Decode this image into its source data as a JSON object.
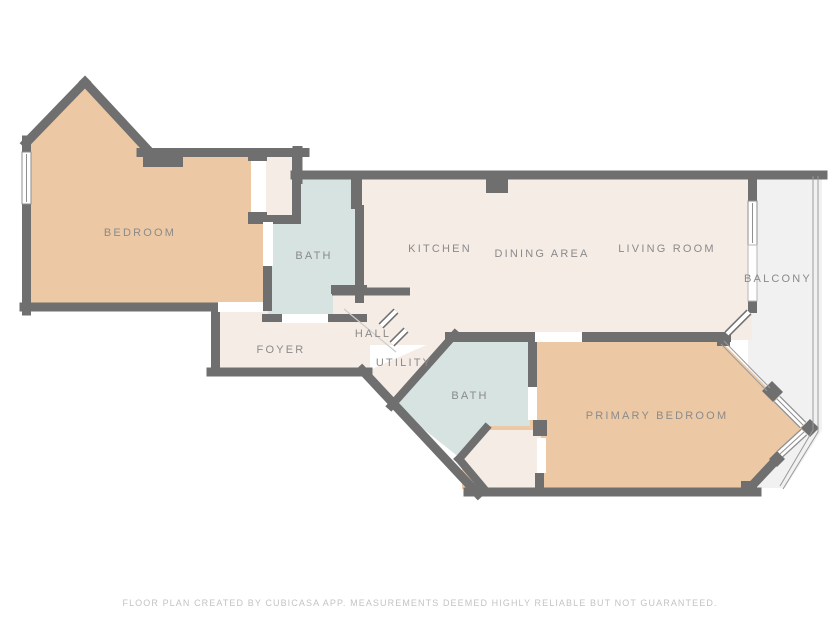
{
  "floor_plan": {
    "rooms": {
      "bedroom": {
        "label": "BEDROOM"
      },
      "bath": {
        "label": "BATH"
      },
      "kitchen": {
        "label": "KITCHEN"
      },
      "dining_area": {
        "label": "DINING AREA"
      },
      "living_room": {
        "label": "LIVING ROOM"
      },
      "balcony": {
        "label": "BALCONY"
      },
      "foyer": {
        "label": "FOYER"
      },
      "hall": {
        "label": "HALL"
      },
      "utility": {
        "label": "UTILITY"
      },
      "bath2": {
        "label": "BATH"
      },
      "primary_bedroom": {
        "label": "PRIMARY BEDROOM"
      }
    },
    "footer": "FLOOR PLAN CREATED BY CUBICASA APP. MEASUREMENTS DEEMED HIGHLY RELIABLE BUT NOT GUARANTEED.",
    "colors": {
      "wall": "#6f6f6f",
      "bedroom_fill": "#ecc9a4",
      "bath_fill": "#d6e3e1",
      "living_fill": "#f6ece6",
      "balcony_fill": "#f1f1f1",
      "window_fill": "#fefefe",
      "window_frame": "#8f8f8f",
      "glass_frame": "#b5b5b5",
      "railing": "#9a9a9a",
      "door_gap": "#ffffff",
      "swing_line": "#cccccc",
      "label_text": "#8a8a8a",
      "footer_text": "#c3c3c3",
      "background": "#ffffff"
    }
  }
}
